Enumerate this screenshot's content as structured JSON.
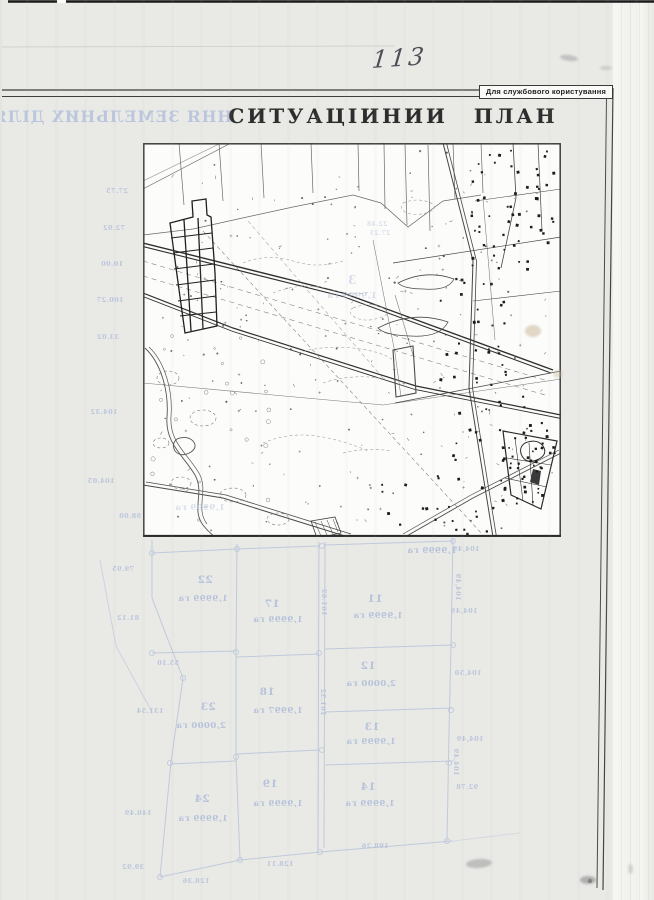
{
  "document": {
    "handwritten_page_number": "113",
    "classification_label": "Для службового користування",
    "title": "СИТУАЦІИНИИ ПЛАН"
  },
  "bleed_through": {
    "reverse_title_fragment": "ННЯ ЗЕМЕЛЬНИХ ДІЛЯНОК",
    "parcel_labels": [
      {
        "t": "22",
        "x": 205,
        "y": 583,
        "s": 10.5
      },
      {
        "t": "1,9999 га",
        "x": 203,
        "y": 601,
        "s": 8.5
      },
      {
        "t": "17",
        "x": 272,
        "y": 607,
        "s": 10.5
      },
      {
        "t": "1,9999 га",
        "x": 278,
        "y": 622,
        "s": 8.5
      },
      {
        "t": "11",
        "x": 375,
        "y": 602,
        "s": 10.5
      },
      {
        "t": "1,9999 га",
        "x": 378,
        "y": 618,
        "s": 8.5
      },
      {
        "t": "12",
        "x": 368,
        "y": 669,
        "s": 10.5
      },
      {
        "t": "2,0000 га",
        "x": 371,
        "y": 686,
        "s": 8.5
      },
      {
        "t": "18",
        "x": 267,
        "y": 695,
        "s": 10.5
      },
      {
        "t": "1,9997 га",
        "x": 278,
        "y": 713,
        "s": 8.5
      },
      {
        "t": "23",
        "x": 208,
        "y": 710,
        "s": 10.5
      },
      {
        "t": "2,0000 га",
        "x": 201,
        "y": 728,
        "s": 8.5
      },
      {
        "t": "13",
        "x": 372,
        "y": 730,
        "s": 10.5
      },
      {
        "t": "1,9999 га",
        "x": 371,
        "y": 744,
        "s": 8.5
      },
      {
        "t": "19",
        "x": 270,
        "y": 787,
        "s": 10.5
      },
      {
        "t": "1,9999 га",
        "x": 278,
        "y": 806,
        "s": 8.5
      },
      {
        "t": "14",
        "x": 368,
        "y": 790,
        "s": 10.5
      },
      {
        "t": "1,9999 га",
        "x": 370,
        "y": 806,
        "s": 8.5
      },
      {
        "t": "24",
        "x": 202,
        "y": 802,
        "s": 10.5
      },
      {
        "t": "1,9999 га",
        "x": 203,
        "y": 821,
        "s": 8.5
      },
      {
        "t": "1,9999 га",
        "x": 432,
        "y": 553,
        "s": 8.5
      }
    ],
    "measurements": [
      {
        "t": "27.75",
        "x": 117,
        "y": 193
      },
      {
        "t": "72.92",
        "x": 114,
        "y": 230
      },
      {
        "t": "10.00",
        "x": 112,
        "y": 266
      },
      {
        "t": "100.27",
        "x": 110,
        "y": 302
      },
      {
        "t": "33.02",
        "x": 108,
        "y": 339
      },
      {
        "t": "104.32",
        "x": 104,
        "y": 414
      },
      {
        "t": "104.05",
        "x": 101,
        "y": 483
      },
      {
        "t": "98.00",
        "x": 130,
        "y": 518
      },
      {
        "t": "79.95",
        "x": 123,
        "y": 571
      },
      {
        "t": "81.12",
        "x": 128,
        "y": 620
      },
      {
        "t": "55.10",
        "x": 168,
        "y": 665
      },
      {
        "t": "131.54",
        "x": 150,
        "y": 713
      },
      {
        "t": "140.49",
        "x": 138,
        "y": 815
      },
      {
        "t": "39.92",
        "x": 133,
        "y": 869
      },
      {
        "t": "104,49",
        "x": 466,
        "y": 551
      },
      {
        "t": "104,49",
        "x": 464,
        "y": 613
      },
      {
        "t": "104,50",
        "x": 468,
        "y": 675
      },
      {
        "t": "104,49",
        "x": 470,
        "y": 741
      },
      {
        "t": "92.78",
        "x": 467,
        "y": 789
      },
      {
        "t": "198.26",
        "x": 375,
        "y": 848
      },
      {
        "t": "128.11",
        "x": 280,
        "y": 866
      },
      {
        "t": "128.36",
        "x": 196,
        "y": 883
      },
      {
        "t": "161.62",
        "x": 322,
        "y": 602,
        "r": 90
      },
      {
        "t": "161.52",
        "x": 321,
        "y": 702,
        "r": 90
      },
      {
        "t": "104,49",
        "x": 456,
        "y": 587,
        "r": 90
      },
      {
        "t": "104,49",
        "x": 454,
        "y": 762,
        "r": 90
      }
    ],
    "map_overlay_labels": [
      {
        "t": "3",
        "x": 352,
        "y": 284,
        "s": 12
      },
      {
        "t": "1,9999 га",
        "x": 352,
        "y": 298,
        "s": 8.5
      },
      {
        "t": "1,9999 га",
        "x": 200,
        "y": 510,
        "s": 8.5
      },
      {
        "t": "22.48",
        "x": 377,
        "y": 226,
        "s": 6
      },
      {
        "t": "27.25",
        "x": 380,
        "y": 235,
        "s": 6
      }
    ]
  },
  "colors": {
    "bleed_ink": "#b4c1da",
    "map_ink": "#3a3a3a",
    "title_ink": "#2d2d2d"
  }
}
